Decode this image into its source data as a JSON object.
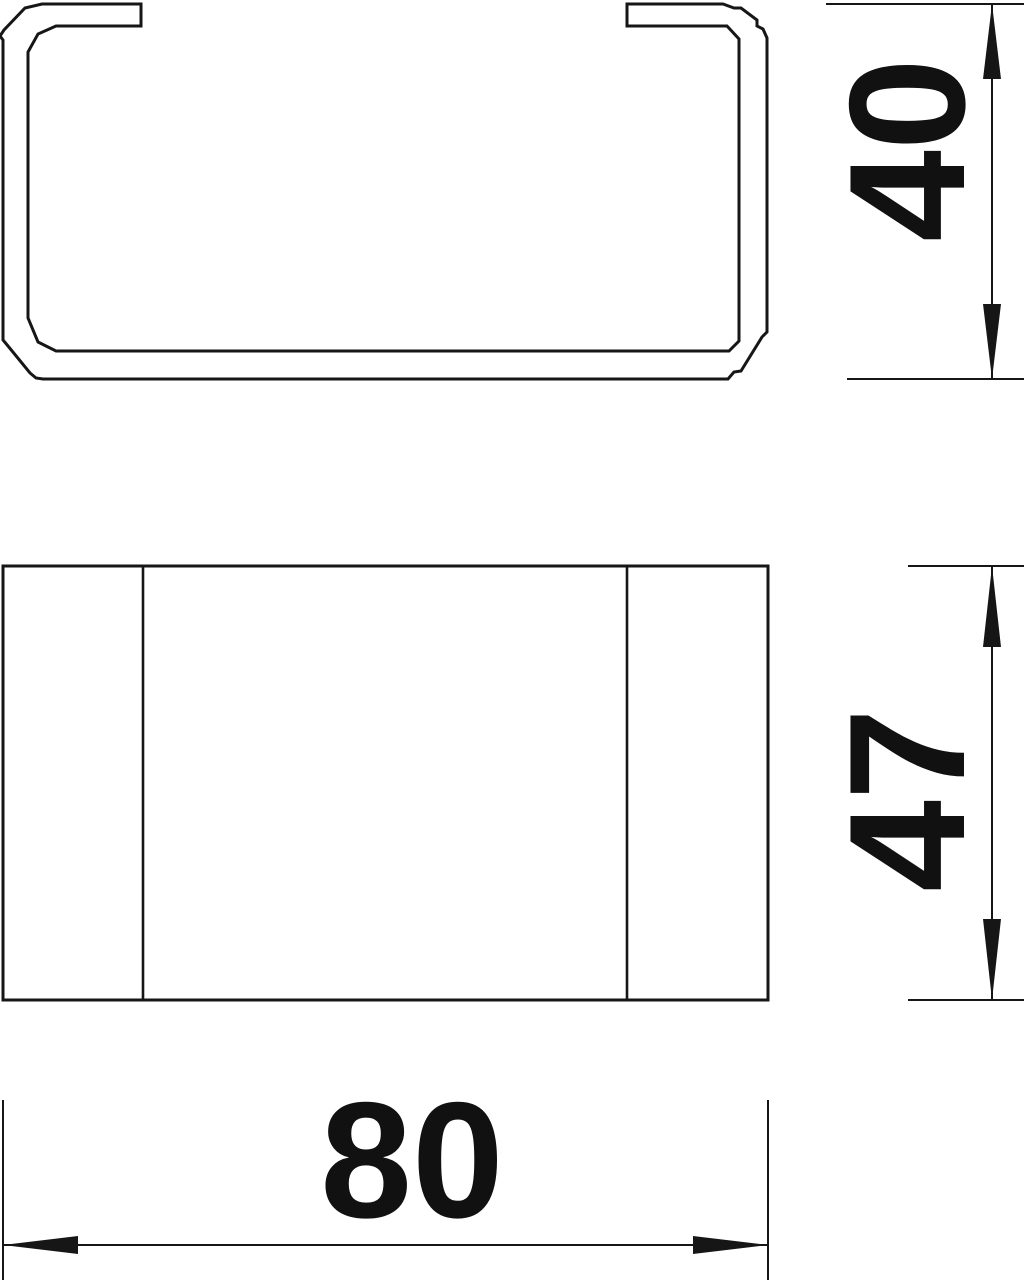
{
  "colors": {
    "background": "#ffffff",
    "line": "#161616",
    "text": "#111111"
  },
  "views": {
    "cross_section": {
      "name": "channel-cross-section"
    },
    "front": {
      "name": "end-piece-front-view"
    }
  },
  "dimensions": {
    "height": {
      "label": "40",
      "orientation": "vertical"
    },
    "depth": {
      "label": "47",
      "orientation": "vertical"
    },
    "width": {
      "label": "80",
      "orientation": "horizontal"
    }
  }
}
